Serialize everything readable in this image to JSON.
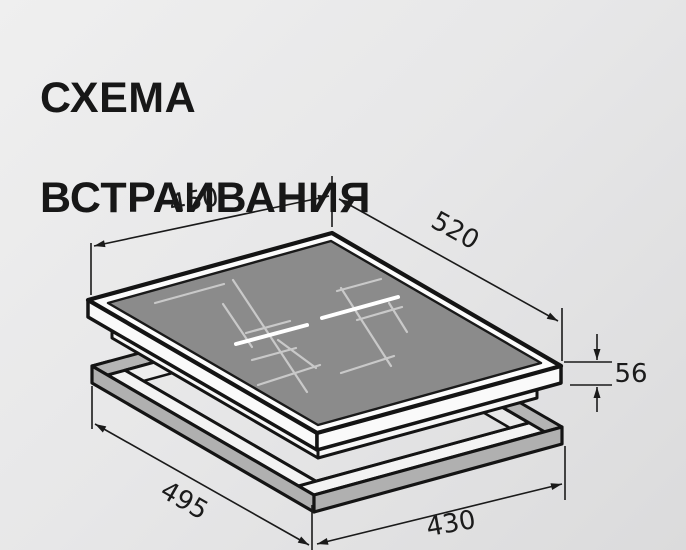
{
  "title": {
    "line1": "СХЕМА",
    "line2": "ВСТРАИВАНИЯ"
  },
  "dimensions": {
    "cooktop_width": "450",
    "cooktop_depth": "520",
    "cooktop_height": "56",
    "cutout_depth": "495",
    "cutout_width": "430"
  },
  "colors": {
    "background": "#e7e7e8",
    "outline_black": "#141414",
    "glass_surface_gray": "#8b8b8b",
    "glass_bezel_white": "#fcfcfc",
    "frame_top_white": "#f3f3f3",
    "frame_side_gray": "#b2b2b2",
    "zone_marking_gray": "#c9c9c9",
    "zone_marking_white": "#ffffff",
    "dimension_line": "#1a1a1a"
  }
}
